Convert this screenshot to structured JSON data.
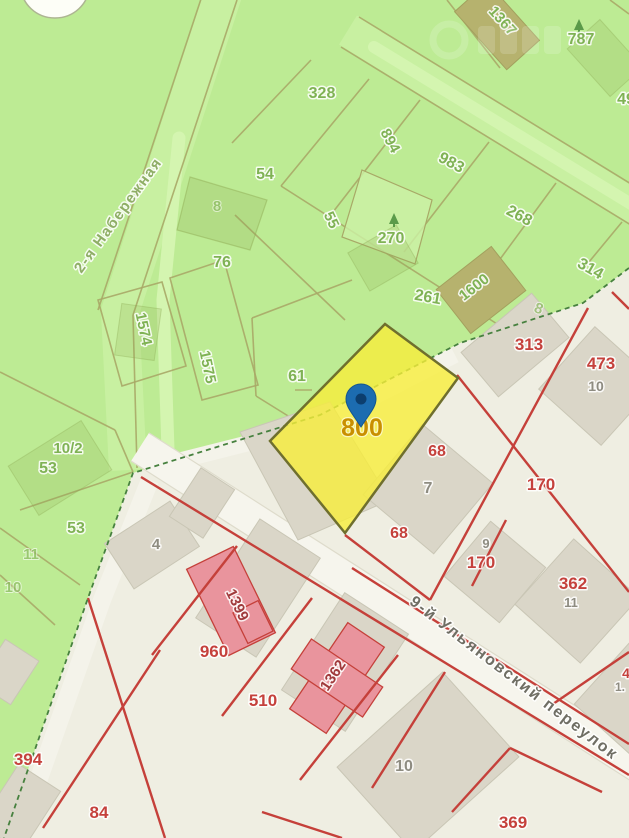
{
  "map": {
    "type": "cadastral-map",
    "watermark": "illegible-ghost-logo",
    "highlighted_parcel": {
      "number": "800",
      "fill": "#f7ee3b",
      "border": "#6f6f2e",
      "pin_color": "#1c6cb0"
    },
    "zones": {
      "green_fill": "#bdeb94",
      "urban_fill": "#efeee2",
      "road_fill": "#f6f5ed",
      "red_line": "#c5403a",
      "olive_line": "#a8a967",
      "boundary_dash": "#47813f"
    },
    "streets": [
      {
        "name": "2-я Набережная"
      },
      {
        "name": "9-й Ульяновский переулок"
      }
    ],
    "labels": [
      {
        "text": "328",
        "x": 322,
        "y": 98,
        "cls": "green"
      },
      {
        "text": "1367",
        "x": 499,
        "y": 24,
        "rot": 48,
        "cls": "green",
        "size": 15
      },
      {
        "text": "787",
        "x": 581,
        "y": 44,
        "cls": "green"
      },
      {
        "text": "49",
        "x": 626,
        "y": 104,
        "cls": "green"
      },
      {
        "text": "894",
        "x": 386,
        "y": 143,
        "rot": 62,
        "cls": "green",
        "size": 15
      },
      {
        "text": "983",
        "x": 449,
        "y": 167,
        "rot": 28,
        "cls": "green"
      },
      {
        "text": "55",
        "x": 327,
        "y": 222,
        "rot": 65,
        "cls": "green",
        "size": 15
      },
      {
        "text": "268",
        "x": 517,
        "y": 220,
        "rot": 28,
        "cls": "green"
      },
      {
        "text": "314",
        "x": 588,
        "y": 273,
        "rot": 30,
        "cls": "green"
      },
      {
        "text": "270",
        "x": 391,
        "y": 243,
        "cls": "green"
      },
      {
        "text": "261",
        "x": 427,
        "y": 302,
        "rot": 10,
        "cls": "green"
      },
      {
        "text": "1600",
        "x": 477,
        "y": 291,
        "rot": -38,
        "cls": "green",
        "size": 15
      },
      {
        "text": "8",
        "x": 537,
        "y": 313,
        "rot": 20,
        "cls": "green-faint",
        "size": 15
      },
      {
        "text": "8",
        "x": 217,
        "y": 211,
        "cls": "green-faint",
        "size": 15
      },
      {
        "text": "54",
        "x": 265,
        "y": 179,
        "cls": "green"
      },
      {
        "text": "76",
        "x": 222,
        "y": 267,
        "cls": "green"
      },
      {
        "text": "1574",
        "x": 139,
        "y": 330,
        "rot": 78,
        "cls": "green",
        "size": 15
      },
      {
        "text": "1575",
        "x": 203,
        "y": 368,
        "rot": 78,
        "cls": "green",
        "size": 15
      },
      {
        "text": "61",
        "x": 297,
        "y": 381,
        "cls": "green"
      },
      {
        "text": "10/2",
        "x": 68,
        "y": 453,
        "cls": "green",
        "size": 15
      },
      {
        "text": "53",
        "x": 48,
        "y": 473,
        "cls": "green"
      },
      {
        "text": "53",
        "x": 76,
        "y": 533,
        "cls": "green"
      },
      {
        "text": "11",
        "x": 31,
        "y": 559,
        "cls": "green-faint",
        "size": 15
      },
      {
        "text": "10",
        "x": 13,
        "y": 592,
        "cls": "green-faint",
        "size": 15
      },
      {
        "text": "2-я Набережная",
        "x": 122,
        "y": 218,
        "rot": -54,
        "cls": "street-green",
        "size": 15,
        "name": "street-label-naberezhnaya"
      },
      {
        "text": "313",
        "x": 529,
        "y": 350,
        "cls": "red",
        "size": 17
      },
      {
        "text": "473",
        "x": 601,
        "y": 369,
        "cls": "red",
        "size": 17
      },
      {
        "text": "10",
        "x": 596,
        "y": 391,
        "cls": "gray",
        "size": 14
      },
      {
        "text": "68",
        "x": 437,
        "y": 456,
        "cls": "red"
      },
      {
        "text": "7",
        "x": 428,
        "y": 493,
        "cls": "gray"
      },
      {
        "text": "68",
        "x": 399,
        "y": 538,
        "cls": "red"
      },
      {
        "text": "9",
        "x": 486,
        "y": 548,
        "cls": "gray",
        "size": 13
      },
      {
        "text": "170",
        "x": 481,
        "y": 568,
        "cls": "red",
        "size": 17
      },
      {
        "text": "170",
        "x": 541,
        "y": 490,
        "cls": "red",
        "size": 17
      },
      {
        "text": "362",
        "x": 573,
        "y": 589,
        "cls": "red",
        "size": 17
      },
      {
        "text": "11",
        "x": 571,
        "y": 607,
        "cls": "gray",
        "size": 13
      },
      {
        "text": "4",
        "x": 156,
        "y": 549,
        "cls": "gray",
        "size": 15
      },
      {
        "text": "1399",
        "x": 233,
        "y": 607,
        "rot": 64,
        "cls": "darkred",
        "size": 15
      },
      {
        "text": "960",
        "x": 214,
        "y": 657,
        "cls": "red",
        "size": 17
      },
      {
        "text": "510",
        "x": 263,
        "y": 706,
        "cls": "red",
        "size": 17
      },
      {
        "text": "1362",
        "x": 337,
        "y": 678,
        "rot": -56,
        "cls": "darkred",
        "size": 15
      },
      {
        "text": "394",
        "x": 28,
        "y": 765,
        "cls": "red",
        "size": 17
      },
      {
        "text": "84",
        "x": 99,
        "y": 818,
        "cls": "red",
        "size": 17
      },
      {
        "text": "10",
        "x": 404,
        "y": 771,
        "cls": "gray",
        "size": 16
      },
      {
        "text": "369",
        "x": 513,
        "y": 828,
        "cls": "red",
        "size": 17
      },
      {
        "text": "4",
        "x": 626,
        "y": 678,
        "cls": "red",
        "size": 14
      },
      {
        "text": "1.",
        "x": 620,
        "y": 691,
        "cls": "gray",
        "size": 12
      },
      {
        "text": "9-й Ульяновский переулок",
        "x": 511,
        "y": 682,
        "rot": 37.5,
        "cls": "street-gray",
        "size": 16,
        "name": "street-label-ulyanovsky"
      },
      {
        "text": "800",
        "x": 362,
        "y": 436,
        "cls": "gold",
        "size": 25,
        "name": "highlighted-parcel-number"
      }
    ]
  }
}
